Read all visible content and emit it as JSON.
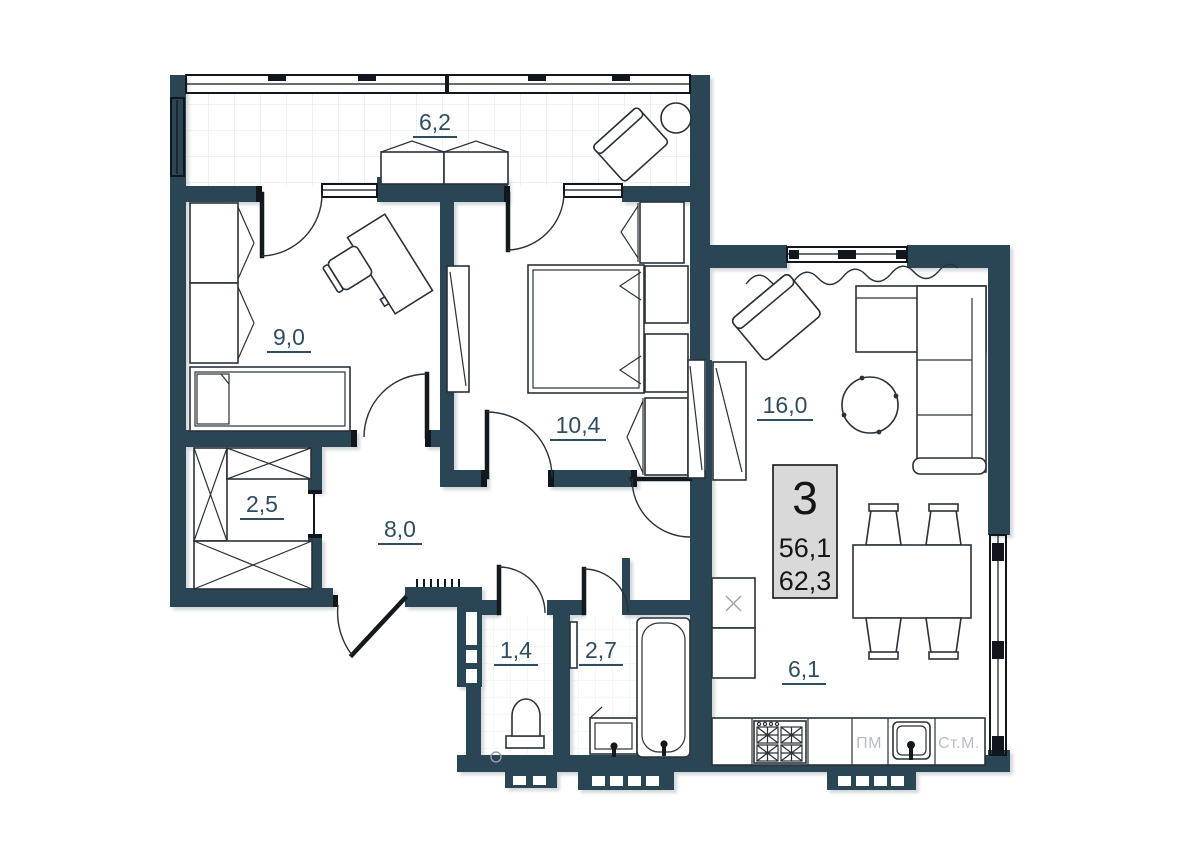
{
  "unit_card": {
    "rooms_count": "3",
    "living_area": "56,1",
    "total_area": "62,3"
  },
  "rooms": {
    "balcony": {
      "area": "6,2"
    },
    "bedroom_1": {
      "area": "9,0"
    },
    "bedroom_2": {
      "area": "10,4"
    },
    "living_room": {
      "area": "16,0"
    },
    "storage": {
      "area": "2,5"
    },
    "hallway": {
      "area": "8,0"
    },
    "wc": {
      "area": "1,4"
    },
    "bathroom": {
      "area": "2,7"
    },
    "kitchen": {
      "area": "6,1"
    }
  },
  "appliances": {
    "dishwasher": "ПМ",
    "washing_machine": "Ст.М."
  },
  "colors": {
    "wall": "#2b4553",
    "label": "#2e4d61",
    "appliance_text": "#b9bec3",
    "info_box_bg": "#d9d9d9"
  }
}
